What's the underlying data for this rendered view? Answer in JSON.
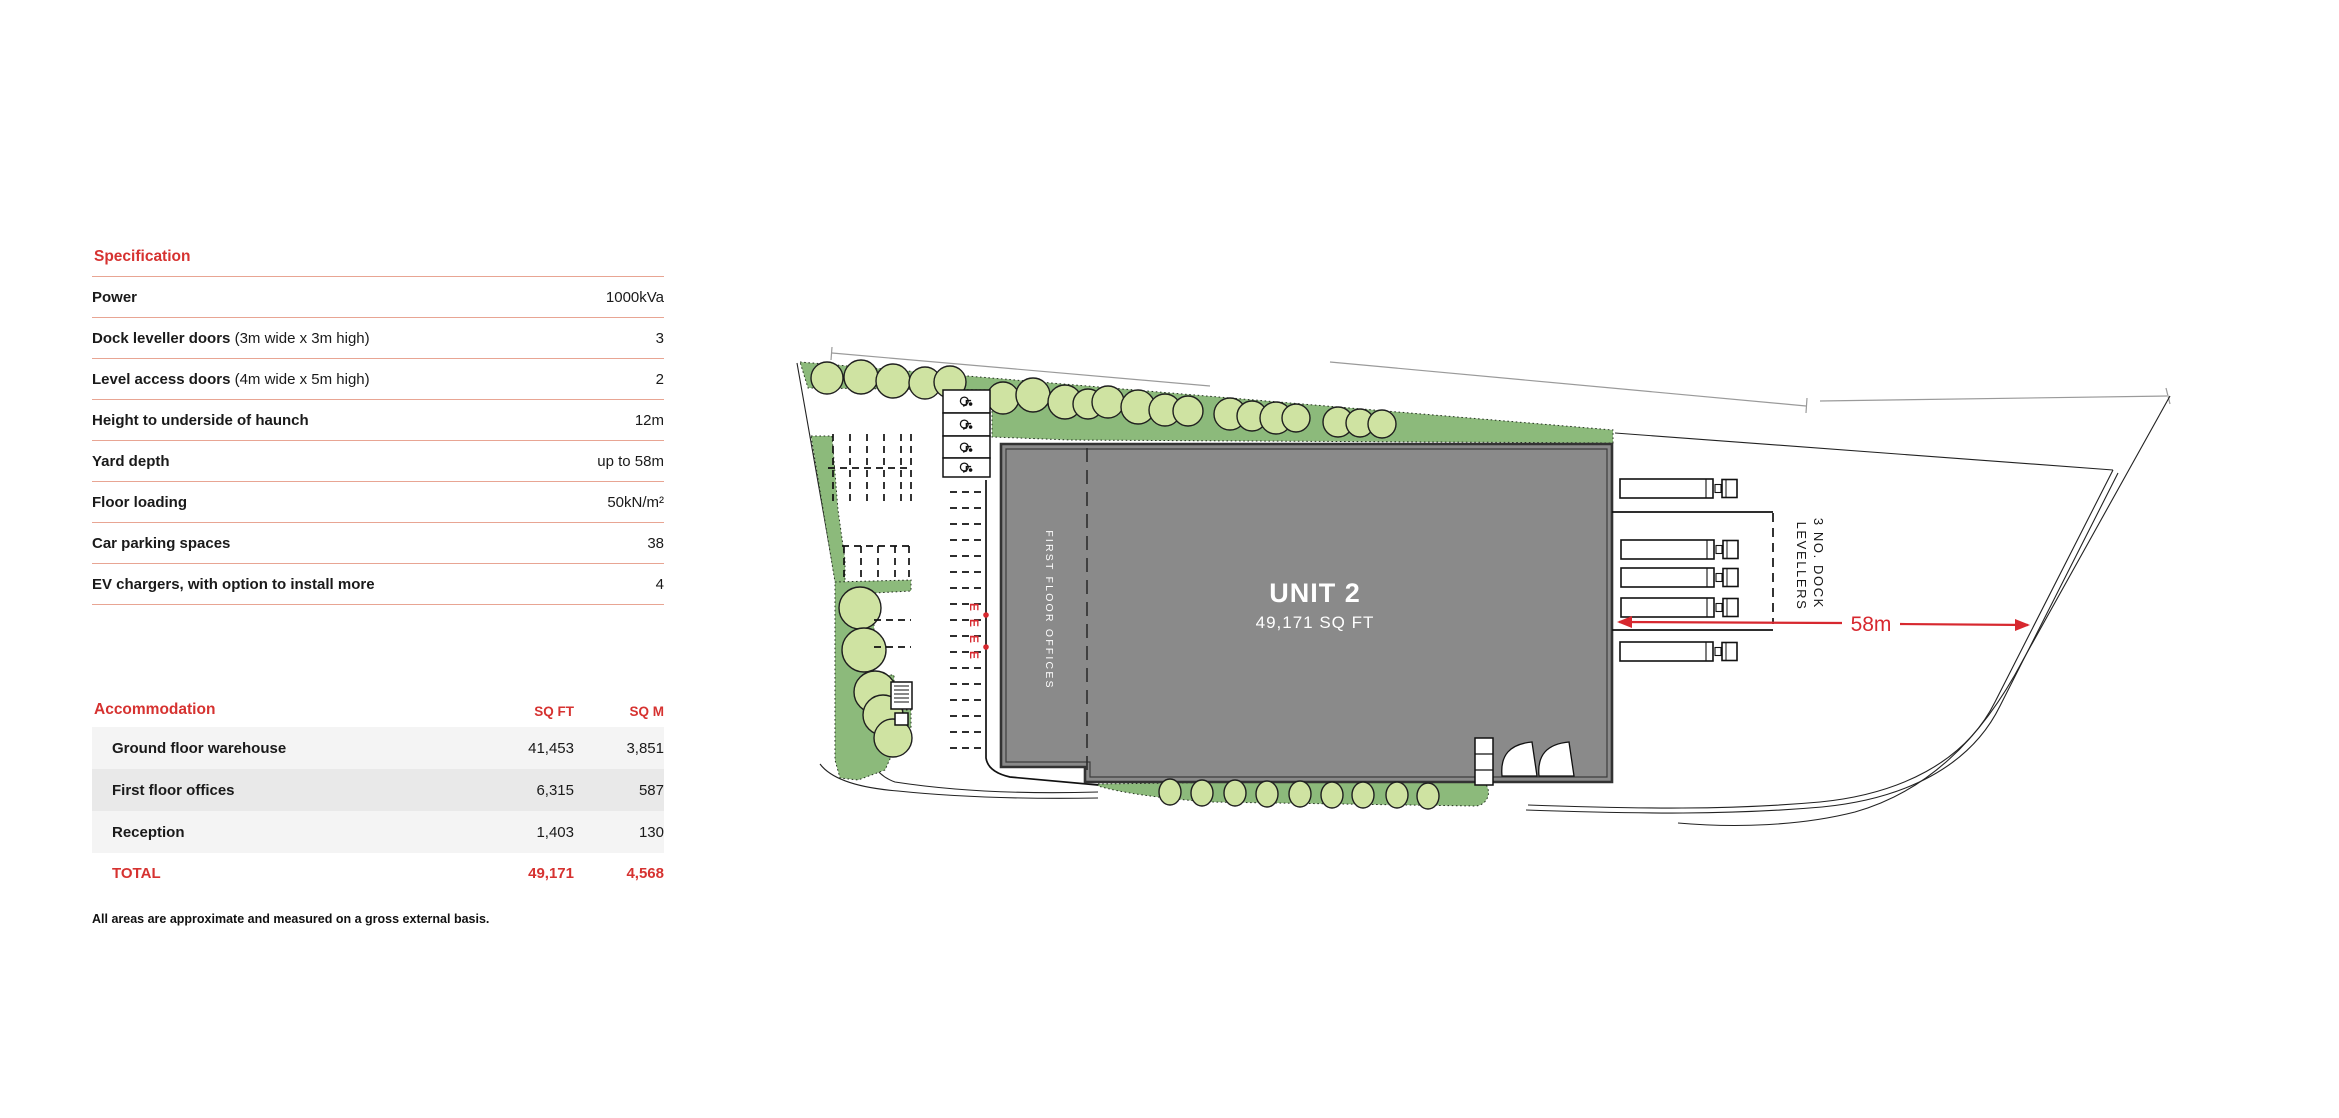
{
  "accent": "#d63230",
  "spec": {
    "title": "Specification",
    "rows": [
      {
        "label": "Power",
        "note": "",
        "value": "1000kVa"
      },
      {
        "label": "Dock leveller doors",
        "note": " (3m wide x 3m high)",
        "value": "3"
      },
      {
        "label": "Level access doors",
        "note": " (4m wide x 5m high)",
        "value": "2"
      },
      {
        "label": "Height to underside of haunch",
        "note": "",
        "value": "12m"
      },
      {
        "label": "Yard depth",
        "note": "",
        "value": "up to 58m"
      },
      {
        "label": "Floor loading",
        "note": "",
        "value": "50kN/m²"
      },
      {
        "label": "Car parking spaces",
        "note": "",
        "value": "38"
      },
      {
        "label": "EV chargers, with option to install more",
        "note": "",
        "value": "4"
      }
    ]
  },
  "accommodation": {
    "title": "Accommodation",
    "col_sqft": "SQ FT",
    "col_sqm": "SQ M",
    "rows": [
      {
        "label": "Ground floor warehouse",
        "sqft": "41,453",
        "sqm": "3,851"
      },
      {
        "label": "First floor offices",
        "sqft": "6,315",
        "sqm": "587"
      },
      {
        "label": "Reception",
        "sqft": "1,403",
        "sqm": "130"
      }
    ],
    "total": {
      "label": "TOTAL",
      "sqft": "49,171",
      "sqm": "4,568"
    },
    "footnote": "All areas are approximate and measured on a gross external basis."
  },
  "plan": {
    "unit_name": "UNIT 2",
    "unit_area": "49,171 SQ FT",
    "office_label": "FIRST FLOOR OFFICES",
    "dock_label_line1": "3 NO. DOCK",
    "dock_label_line2": "LEVELLERS",
    "yard_dimension": "58m",
    "ev_bay_label": "E"
  }
}
